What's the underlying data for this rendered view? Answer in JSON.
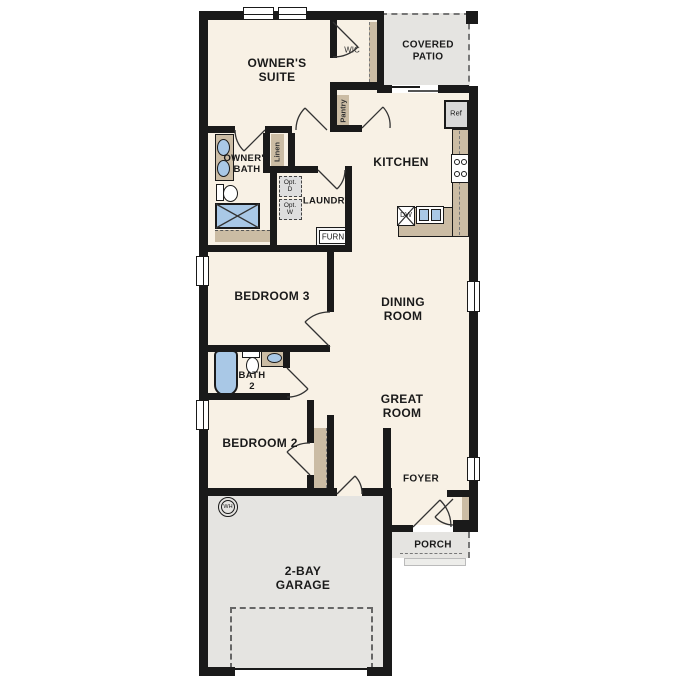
{
  "colors": {
    "wall": "#1a1a1a",
    "floor": "#f8f1e5",
    "ext": "#e5e4e1",
    "tan": "#cbbca4",
    "blue": "#a9c8e6",
    "dash": "#777777",
    "appl": "#d8d8d8",
    "step": "#ededea",
    "ink": "#1a1a1a"
  },
  "rooms": {
    "owners_suite": "OWNER'S\nSUITE",
    "wic": "WIC",
    "covered_patio": "COVERED\nPATIO",
    "owners_bath": "OWNER'S\nBATH",
    "kitchen": "KITCHEN",
    "laundry": "LAUNDRY",
    "bedroom3": "BEDROOM 3",
    "dining_room": "DINING\nROOM",
    "bath2": "BATH\n2",
    "great_room": "GREAT\nROOM",
    "bedroom2": "BEDROOM 2",
    "foyer": "FOYER",
    "porch": "PORCH",
    "garage": "2-BAY\nGARAGE"
  },
  "fixtures": {
    "ref": "Ref",
    "dw": "DW",
    "furn": "FURN",
    "opt_dryer": "Opt.\nD",
    "opt_washer": "Opt.\nW",
    "water_heater": "WH",
    "linen": "Linen",
    "pantry": "Pantry"
  }
}
